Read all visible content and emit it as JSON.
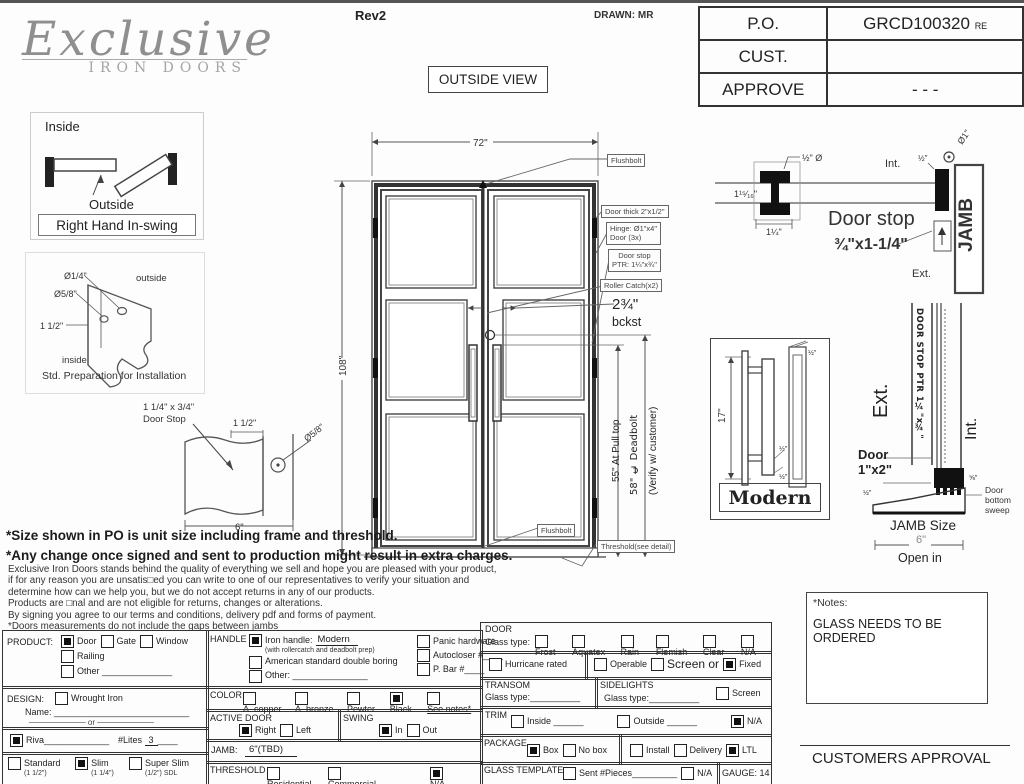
{
  "header": {
    "logo": {
      "script": "Exclusive",
      "sub": "IRON DOORS"
    },
    "rev": "Rev2",
    "drawn": "DRAWN: MR",
    "outside_view": "OUTSIDE VIEW",
    "info_table": [
      {
        "label": "P.O.",
        "value": "GRCD100320",
        "suffix": "RE"
      },
      {
        "label": "CUST.",
        "value": "",
        "suffix": ""
      },
      {
        "label": "APPROVE",
        "value": "- - -",
        "suffix": ""
      }
    ]
  },
  "swing": {
    "inside": "Inside",
    "outside": "Outside",
    "caption": "Right Hand In-swing"
  },
  "prep": {
    "d1": "Ø1/4\"",
    "d2": "Ø5/8\"",
    "d3": "1 1/2\"",
    "outside": "outside",
    "inside": "inside",
    "caption": "Std. Preparation for Installation"
  },
  "stop_detail": {
    "l1": "1 1/4\" x 3/4\"",
    "l2": "Door Stop",
    "d1": "1 1/2\"",
    "d2": "Ø5/8\"",
    "d3": "6\""
  },
  "door": {
    "dim_w": "72\"",
    "dim_h": "108\"",
    "flushbolt_top": "Flushbolt",
    "thick": "Door thick 2\"x1/2\"",
    "hinge1": "Hinge: Ø1\"x4\"",
    "hinge2": "Door (3x)",
    "stop1": "Door stop",
    "stop2": "PTR: 1¼\"x¾\"",
    "roller": "Roller Catch(x2)",
    "bckst1": "2¾\"",
    "bckst2": "bckst",
    "pull": "55\" At Pull top",
    "deadbolt": "58\" ℄ Deadbolt",
    "verify": "(Verify w/ customer)",
    "flushbolt_bottom": "Flushbolt",
    "threshold": "Threshold(see detail)"
  },
  "jamb_head": {
    "half_dia": "½\" Ø",
    "d1": "1¹⁵⁄₁₆\"",
    "d2": "1¼\"",
    "int": "Int.",
    "half": "½\"",
    "dia1": "Ø1\"",
    "title": "Door stop",
    "size": "¾\"x1-1/4\"",
    "jamb": "JAMB",
    "ext": "Ext."
  },
  "handle_detail": {
    "dim": "17\"",
    "caption": "Modern",
    "h1": "½\"",
    "h2": "½\"",
    "h3": "½\""
  },
  "sill": {
    "ext": "Ext.",
    "int": "Int.",
    "stop_vert": "DOOR STOP PTR 1¼\"x¾\"",
    "door1": "Door",
    "door2": "1\"x2\"",
    "dim_small": "½\"",
    "dim_small2": "⅝\"",
    "sweep1": "Door",
    "sweep2": "bottom",
    "sweep3": "sweep",
    "jamb_size": "JAMB Size",
    "six": "6\"",
    "open_in": "Open in"
  },
  "disclaimer": {
    "b1": "*Size shown in PO is unit size including frame and threshold.",
    "b2": "*Any change once signed and sent to production might result in extra charges.",
    "lines": [
      "Exclusive Iron Doors stands behind the quality of everything we sell and hope you are pleased with your product,",
      "if for any reason you are unsatis□ed you can write to one of our representatives to verify your situation and",
      "determine how can we help you, but we do not accept returns in any of our products.",
      "Products are □nal and are not eligible for returns, changes or alterations.",
      "By signing you agree to our terms and conditions, delivery pdf and forms of payment.",
      "*Doors measurements do not include the gaps between jambs"
    ]
  },
  "notes": {
    "title": "*Notes:",
    "body": "GLASS NEEDS TO BE ORDERED"
  },
  "approval": "CUSTOMERS APPROVAL",
  "form": {
    "product": {
      "label": "PRODUCT:",
      "options": [
        {
          "label": "Door",
          "checked": true
        },
        {
          "label": "Gate",
          "checked": false
        },
        {
          "label": "Window",
          "checked": false
        },
        {
          "label": "Railing",
          "checked": false
        },
        {
          "label": "Other ______________",
          "checked": false
        }
      ]
    },
    "design": {
      "label": "DESIGN:",
      "options": [
        {
          "label": "Wrought Iron",
          "checked": false
        }
      ],
      "name_label": "Name:",
      "name_line": "___________________________",
      "or": "────────── or ──────────"
    },
    "riva": {
      "checked": true,
      "label": "Riva",
      "line": "_____________",
      "lites_label": "#Lites",
      "lites_value": "3",
      "lites_line": "____"
    },
    "sizes": {
      "options": [
        {
          "label": "Standard",
          "note": "(1 1/2\")",
          "checked": false
        },
        {
          "label": "Slim",
          "note": "(1 1/4\")",
          "checked": true
        },
        {
          "label": "Super Slim",
          "note": "(1/2\") SDL",
          "checked": false
        }
      ]
    },
    "handle": {
      "label": "HANDLE",
      "left": [
        {
          "label": "Iron handle:",
          "value": "Modern",
          "note": "(with rollercatch and deadbolt prep)",
          "checked": true
        },
        {
          "label": "American standard double boring",
          "checked": false
        },
        {
          "label": "Other: _______________",
          "checked": false
        }
      ],
      "right": [
        {
          "label": "Panic hardware",
          "checked": false
        },
        {
          "label": "Autocloser #____",
          "checked": false
        },
        {
          "label": "P. Bar #____",
          "checked": false
        }
      ]
    },
    "color": {
      "label": "COLOR",
      "options": [
        {
          "label": "A. copper",
          "checked": false
        },
        {
          "label": "A. bronze",
          "checked": false
        },
        {
          "label": "Pewter",
          "checked": false
        },
        {
          "label": "Black",
          "checked": true
        },
        {
          "label": "See notes*",
          "u": true,
          "checked": false
        }
      ]
    },
    "active_door": {
      "label": "ACTIVE DOOR",
      "options": [
        {
          "label": "Right",
          "checked": true
        },
        {
          "label": "Left",
          "checked": false
        }
      ]
    },
    "swing": {
      "label": "SWING",
      "options": [
        {
          "label": "In",
          "checked": true
        },
        {
          "label": "Out",
          "checked": false
        }
      ]
    },
    "jamb": {
      "label": "JAMB:",
      "value": "6\"(TBD)"
    },
    "threshold": {
      "label": "THRESHOLD",
      "options": [
        {
          "label": "Residential",
          "checked": false
        },
        {
          "label": "Commercial________",
          "checked": false
        },
        {
          "label": "N/A ____",
          "checked": true
        }
      ]
    },
    "door_sec": {
      "label": "DOOR",
      "glass_label": "Glass type:",
      "options": [
        {
          "label": "Frost",
          "checked": false
        },
        {
          "label": "Aquatex",
          "checked": false
        },
        {
          "label": "Rain",
          "checked": false
        },
        {
          "label": "Flemish",
          "checked": false
        },
        {
          "label": "Clear",
          "checked": false
        },
        {
          "label": "N/A",
          "checked": false
        }
      ]
    },
    "hurricane": {
      "options": [
        {
          "label": "Hurricane rated",
          "checked": false
        }
      ]
    },
    "operable": {
      "options": [
        {
          "label": "Operable",
          "checked": false
        },
        {
          "label": "Screen or",
          "big": true,
          "checked": false
        },
        {
          "label": "Fixed",
          "checked": true
        }
      ]
    },
    "transom": {
      "label": "TRANSOM",
      "glass_label": "Glass type:",
      "glass_line": "__________"
    },
    "sidelights": {
      "label": "SIDELIGHTS",
      "glass_label": "Glass type:",
      "glass_line": "__________",
      "options": [
        {
          "label": "Screen",
          "checked": false
        }
      ]
    },
    "trim": {
      "label": "TRIM",
      "options": [
        {
          "label": "Inside ______",
          "checked": false
        },
        {
          "label": "Outside ______",
          "checked": false
        },
        {
          "label": "N/A",
          "checked": true
        }
      ]
    },
    "package": {
      "label": "PACKAGE",
      "left": [
        {
          "label": "Box",
          "checked": true
        },
        {
          "label": "No box",
          "checked": false
        }
      ],
      "right": [
        {
          "label": "Install",
          "checked": false
        },
        {
          "label": "Delivery",
          "checked": false
        },
        {
          "label": "LTL",
          "checked": true
        }
      ]
    },
    "glass_template": {
      "label": "GLASS TEMPLATE",
      "options": [
        {
          "label": "Sent #Pieces_________",
          "checked": false
        },
        {
          "label": "N/A",
          "checked": false
        }
      ],
      "gauge": "GAUGE: 14"
    }
  }
}
